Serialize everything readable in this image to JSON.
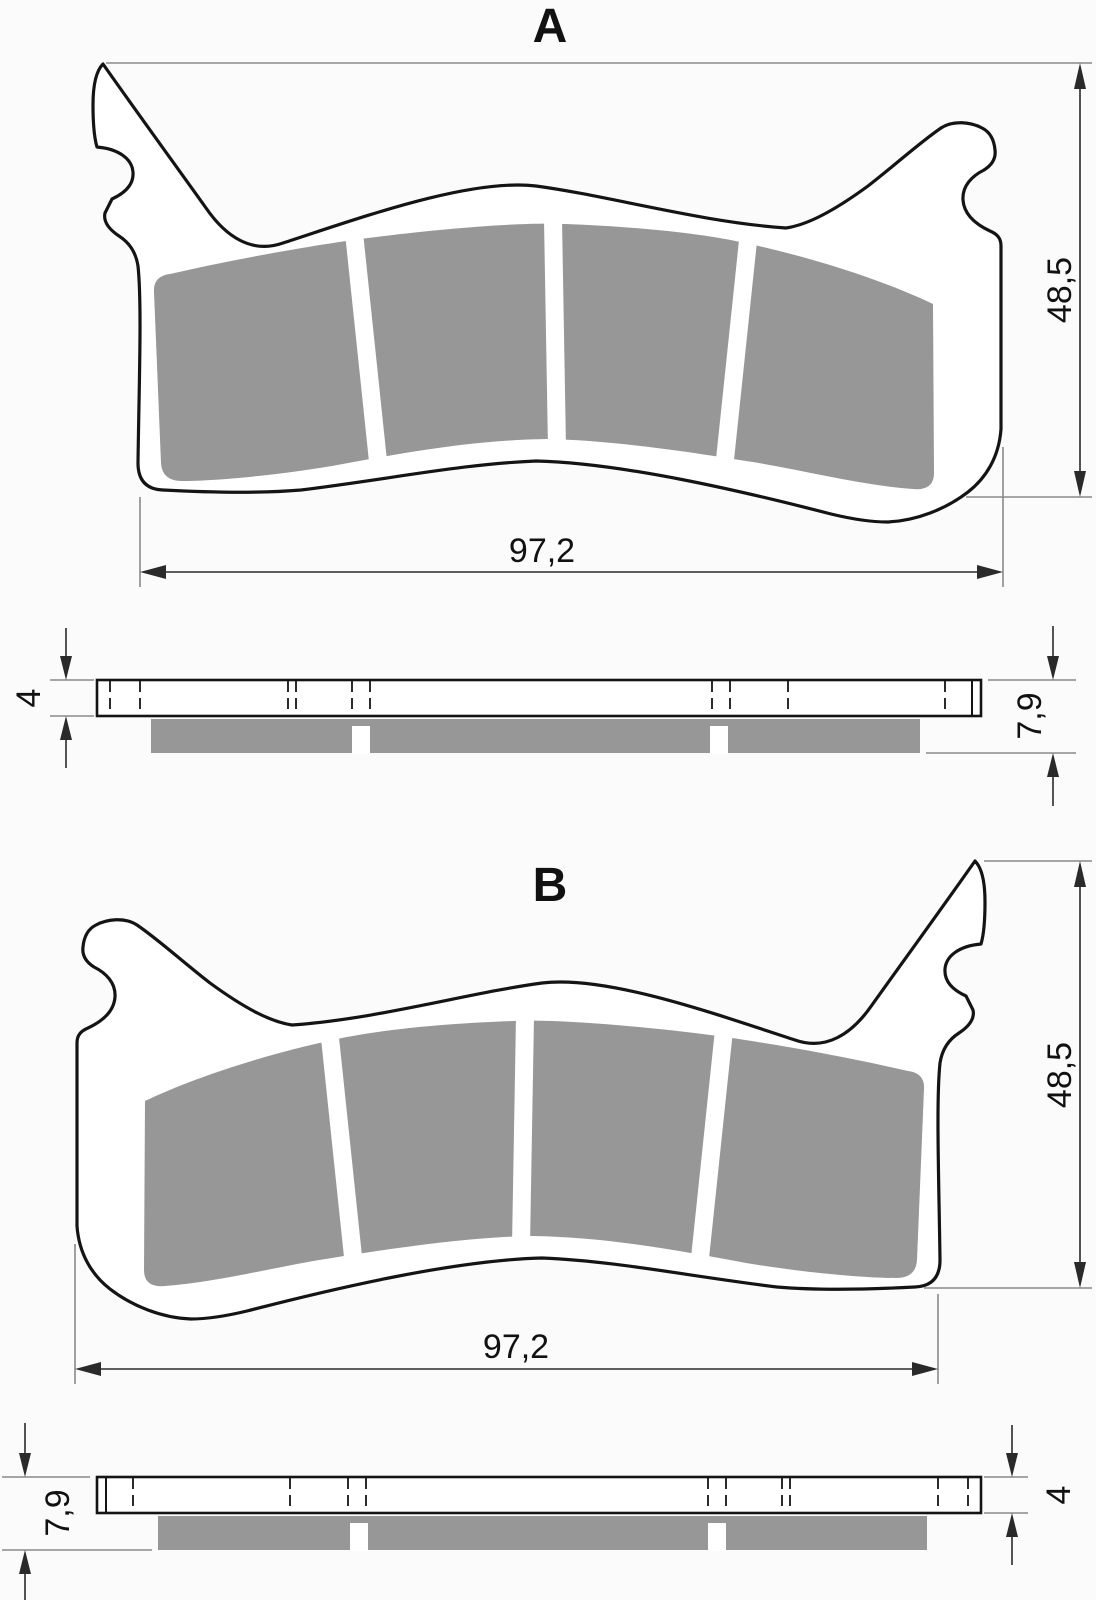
{
  "titles": {
    "view_a": "A",
    "view_b": "B"
  },
  "view_a": {
    "width": "97,2",
    "height": "48,5",
    "plate_thickness": "4",
    "total_thickness": "7,9"
  },
  "view_b": {
    "width": "97,2",
    "height": "48,5",
    "plate_thickness": "4",
    "total_thickness": "7,9"
  },
  "colors": {
    "outline": "#141414",
    "friction_material": "#979797",
    "dimension_line": "#2a2a2a",
    "extension_line": "#8a8a8a",
    "background": "#fbfbfb"
  }
}
